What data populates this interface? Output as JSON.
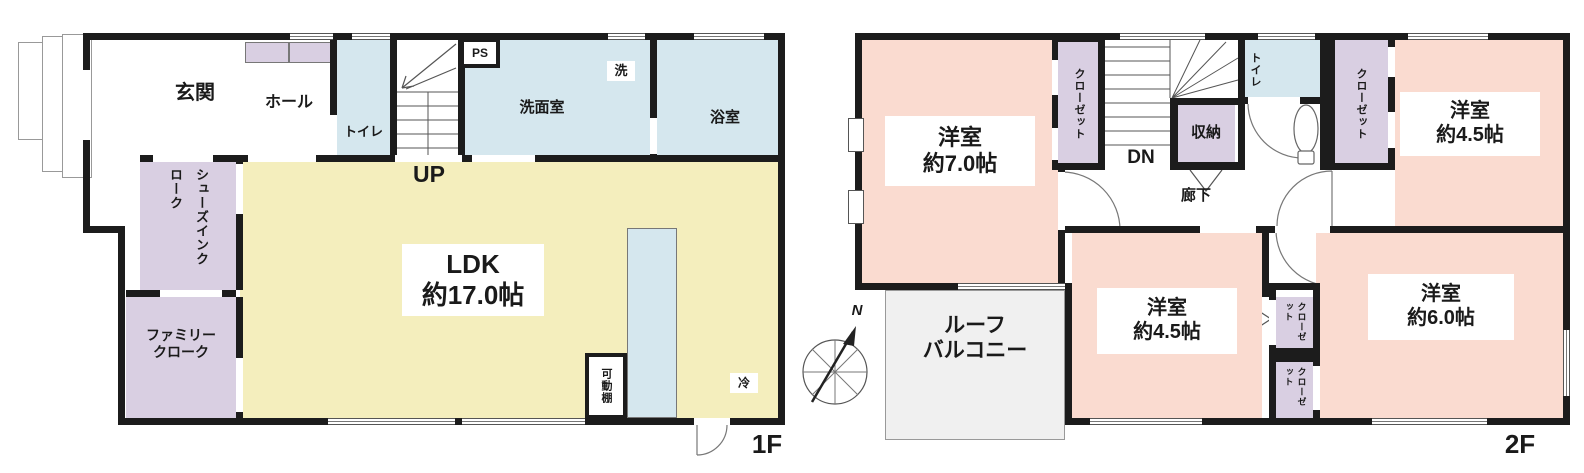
{
  "floor1": {
    "floor_label": "1F",
    "genkan": "玄関",
    "hall": "ホール",
    "toilet": "トイレ",
    "ps": "PS",
    "up": "UP",
    "washroom": "洗面室",
    "washer": "洗",
    "bathroom": "浴室",
    "ldk_name": "LDK",
    "ldk_size": "約17.0帖",
    "shoes_closet": "シューズインクローク",
    "family_closet_1": "ファミリー",
    "family_closet_2": "クローク",
    "movable_shelf": "可動棚",
    "fridge": "冷"
  },
  "floor2": {
    "floor_label": "2F",
    "room7_name": "洋室",
    "room7_size": "約7.0帖",
    "closet_left": "クローゼット",
    "closet_right": "クローゼット",
    "closet_small_1": "クローゼット",
    "closet_small_2": "クローゼット",
    "dn": "DN",
    "storage": "収納",
    "hallway": "廊下",
    "toilet": "トイレ",
    "room45a_name": "洋室",
    "room45a_size": "約4.5帖",
    "room45b_name": "洋室",
    "room45b_size": "約4.5帖",
    "room6_name": "洋室",
    "room6_size": "約6.0帖",
    "balcony_1": "ルーフ",
    "balcony_2": "バルコニー"
  },
  "compass": {
    "north": "N"
  },
  "colors": {
    "wall": "#1c1c1c",
    "ldk_yellow": "#f4eebd",
    "room_pink": "#fadbd0",
    "closet_purple": "#d9cfe2",
    "wet_blue": "#d5e7ee",
    "balcony_gray": "#f0f0f0"
  }
}
